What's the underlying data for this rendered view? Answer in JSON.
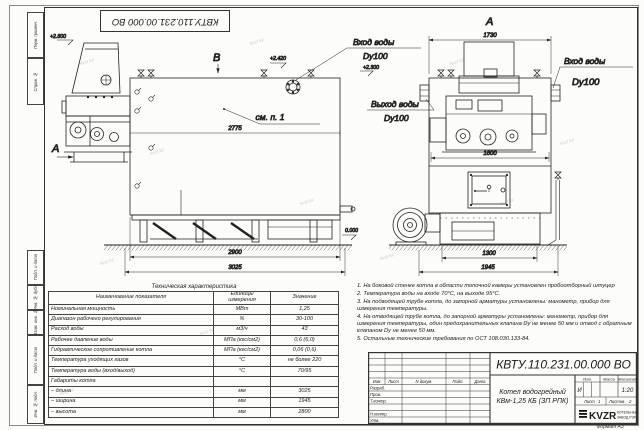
{
  "sheet": {
    "watermark": "kvzr.kz",
    "format_note": "Формат А3"
  },
  "stamp": {
    "doc_number": "КВТУ.110.231.00.000  ВО"
  },
  "margin": {
    "labels": [
      "Перв. примен.",
      "Справ. №",
      "Подп. и дата",
      "Инв. № дубл.",
      "Взам. инв. №",
      "Подп. и дата",
      "Инв. № подл."
    ]
  },
  "drawing": {
    "side": {
      "view_label": "В",
      "section_arrow": "А",
      "elev_hopper": "+2.800",
      "elev_top": "+2.420",
      "elev_zero": "0.000",
      "see_note": "см. п. 1",
      "dim_drum": "2775",
      "dim_frame": "2900",
      "dim_length": "3025"
    },
    "front": {
      "view_title": "А",
      "dim_top": "1730",
      "dim_body": "1600",
      "dim_base": "1300",
      "dim_width": "1945",
      "inlet_side_line1": "Вход воды",
      "inlet_side_line2": "Dy100",
      "inlet_side_elev": "+2.300",
      "outlet_line1": "Выход воды",
      "outlet_line2": "Dy100",
      "inlet_right_line1": "Вход воды",
      "inlet_right_line2": "Dy100"
    }
  },
  "tech_table": {
    "title": "Техническая характеристика",
    "col_name": "Наименование показателя",
    "col_units_1": "Единицы",
    "col_units_2": "измерения",
    "col_value": "Значение",
    "rows": [
      {
        "name": "Номинальная мощность",
        "units": "МВт",
        "value": "1,25"
      },
      {
        "name": "Диапазон рабочего регулирования",
        "units": "%",
        "value": "30-100"
      },
      {
        "name": "Расход воды",
        "units": "м3/ч",
        "value": "43"
      },
      {
        "name": "Рабочее давление воды",
        "units": "МПа (кгс/см2)",
        "value": "0,6 (6,0)"
      },
      {
        "name": "Гидравлическое сопротивление котла",
        "units": "МПа (кгс/см2)",
        "value": "0,06 (0,6)"
      },
      {
        "name": "Температура уходящих газов",
        "units": "°С",
        "value": "не более 220"
      },
      {
        "name": "Температура воды (вход/выход)",
        "units": "°С",
        "value": "70/95"
      },
      {
        "name": "Габариты котла",
        "units": "",
        "value": ""
      },
      {
        "name": "– длина",
        "units": "мм",
        "value": "3025"
      },
      {
        "name": "– ширина",
        "units": "мм",
        "value": "1945"
      },
      {
        "name": "– высота",
        "units": "мм",
        "value": "2800"
      }
    ]
  },
  "notes": {
    "items": [
      "1. На боковой стенке котла в области топочной камеры установлен пробоотборный штуцер",
      "2. Температура воды на входе 70°С, на выходе 95°С.",
      "3. На подводящей трубе котла, до запорной арматуры установлены: манометр, прибор для измерения температуры.",
      "4. На отводящей трубе котла, до запорной арматуры установлены: манометр, прибор для измерения температуры, один предохранительных клапана Dу не менее 50 мм и отвод с обратным клапаном Dу не менее 50 мм.",
      "5. Остальные технические требования по ОСТ 108.030.133-84."
    ]
  },
  "titleblock": {
    "doc_number": "КВТУ.110.231.00.000  ВО",
    "name_line1": "Котел водогрейный",
    "name_line2": "КВм-1,25 КБ  (ЗП РПК)",
    "header_cols": [
      "Изм",
      "Лист",
      "N докум.",
      "Подп.",
      "Дата"
    ],
    "row_labels": [
      "Разраб.",
      "Пров.",
      "Т.контр.",
      "Н.контр.",
      "Утв."
    ],
    "lit_label": "Лит.",
    "mass_label": "Масса",
    "scale_label": "Масштаб",
    "lit_value": "И",
    "scale_value": "1:20",
    "sheet_label": "Лист",
    "sheet_value": "1",
    "sheets_label": "Листов",
    "sheets_value": "2",
    "logo_text": "KVZR",
    "company_line1": "КОТЕЛЬНЫЙ",
    "company_line2": "ЗАВОД РЭП"
  }
}
